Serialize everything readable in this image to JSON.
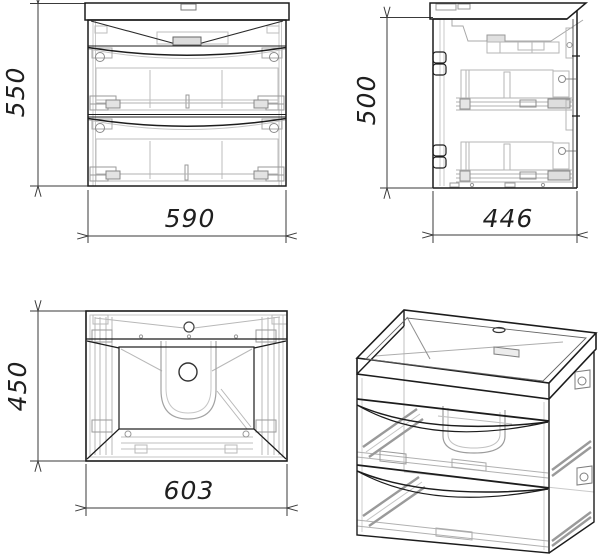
{
  "views": {
    "front": {
      "height_dim": "550",
      "width_dim": "590"
    },
    "side": {
      "height_dim": "500",
      "depth_dim": "446"
    },
    "top": {
      "depth_dim": "450",
      "width_dim": "603"
    }
  },
  "colors": {
    "outline": "#1c1c1c",
    "medium": "#555555",
    "detail": "#b3b3b3",
    "dimension": "#3a3a3a",
    "background": "#ffffff"
  }
}
